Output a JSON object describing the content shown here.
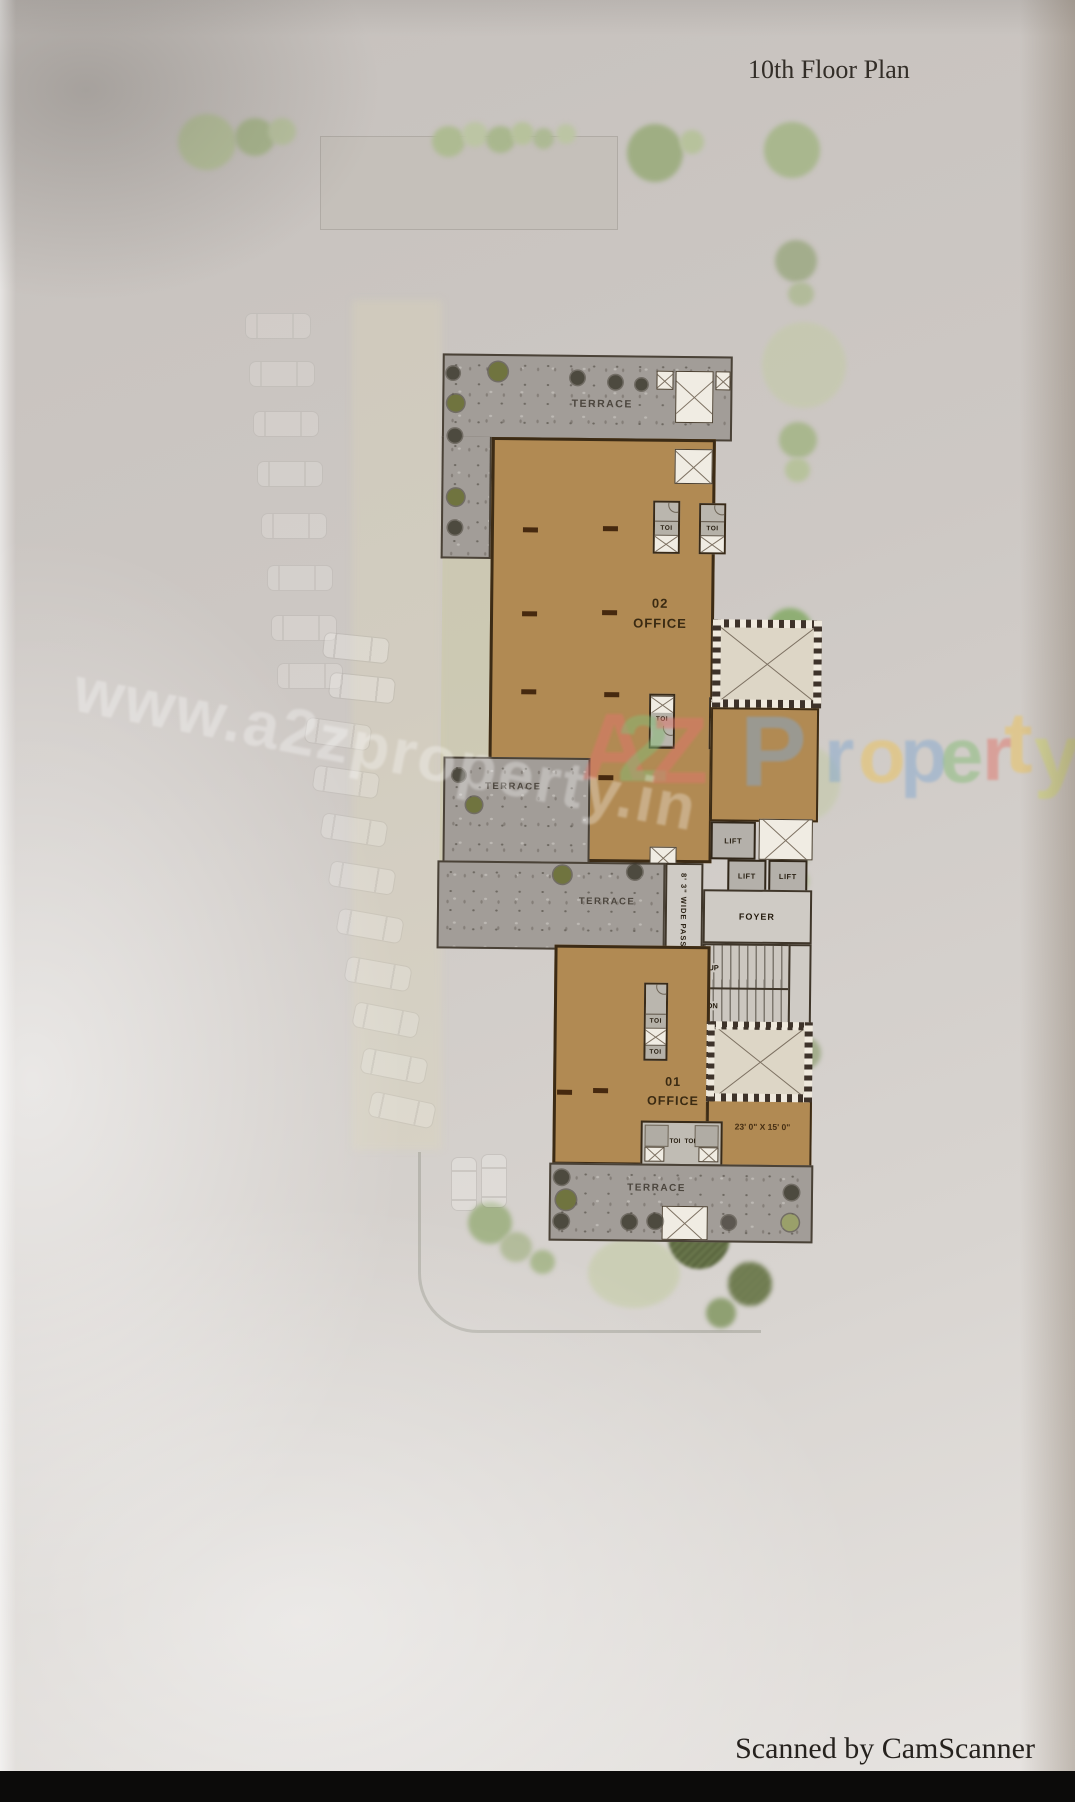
{
  "page": {
    "title": "10th Floor Plan",
    "scanner_credit": "Scanned by CamScanner"
  },
  "watermark": {
    "url_text": "www.a2zproperty.in",
    "letters": [
      {
        "ch": "A",
        "color": "#e0756b"
      },
      {
        "ch": "2",
        "color": "#85bb76"
      },
      {
        "ch": "Z",
        "color": "#e0756b"
      },
      {
        "ch": "P",
        "color": "#84a8cf"
      },
      {
        "ch": "r",
        "color": "#84a8cf"
      },
      {
        "ch": "o",
        "color": "#ecc258"
      },
      {
        "ch": "p",
        "color": "#84a8cf"
      },
      {
        "ch": "e",
        "color": "#85bb76"
      },
      {
        "ch": "r",
        "color": "#e0756b"
      },
      {
        "ch": "t",
        "color": "#ecc258"
      },
      {
        "ch": "y",
        "color": "#d9e06e"
      }
    ]
  },
  "plan": {
    "labels": {
      "terrace": "TERRACE",
      "office2_no": "02",
      "office2": "OFFICE",
      "office1_no": "01",
      "office1": "OFFICE",
      "toi": "TOI",
      "lift": "LIFT",
      "foyer": "FOYER",
      "up": "UP",
      "dn": "DN",
      "passage": "8' 3\" WIDE PASSAGE",
      "dimension": "23' 0\" X 15' 0\""
    },
    "colors": {
      "office_fill": "#b18a53",
      "terrace_fill": "#a29d98",
      "wall": "#3c2b15"
    }
  }
}
